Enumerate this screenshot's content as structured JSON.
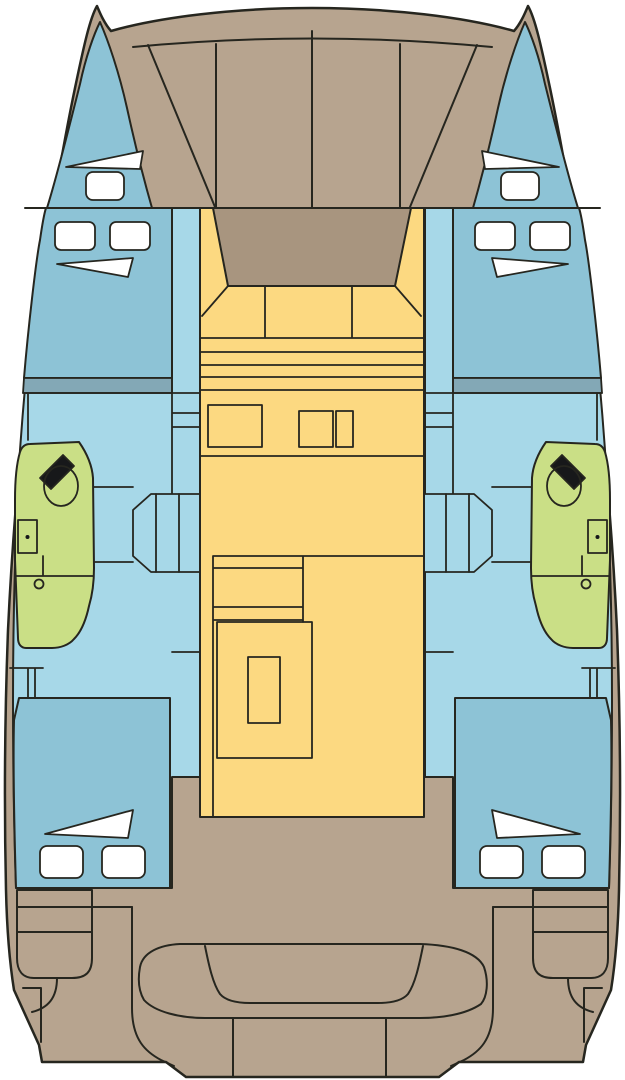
{
  "diagram": {
    "kind": "catamaran-deck-layout-plan",
    "orientation": "bow-at-top-stern-at-bottom",
    "hulls": 2,
    "symmetry": "mirrored-port-starboard"
  },
  "colors": {
    "background": "#ffffff",
    "outline": "#26261f",
    "deck_tan": "#b7a48f",
    "console_tan": "#a8957f",
    "salon_yellow": "#fcd981",
    "cabin_light_blue": "#a7d8e8",
    "berth_blue": "#8dc3d6",
    "berth_step_blue": "#83a8b6",
    "head_green": "#cadf86",
    "hatch_white": "#ffffff",
    "fixture_dark": "#17181a"
  },
  "regions": {
    "foredeck": "trampoline-panels",
    "center": "salon-with-console-seating-galley-and-table",
    "port_hull": "bow-cabin, forward-berth, head-with-shower, aft-berth",
    "starboard_hull": "mirror-of-port-hull",
    "stern": "cockpit-bench, transom-steps, swim-platform"
  },
  "counts": {
    "white_deck_hatches_rect": 10,
    "white_deck_hatches_wedge": 6,
    "trampoline_panels": 4
  }
}
